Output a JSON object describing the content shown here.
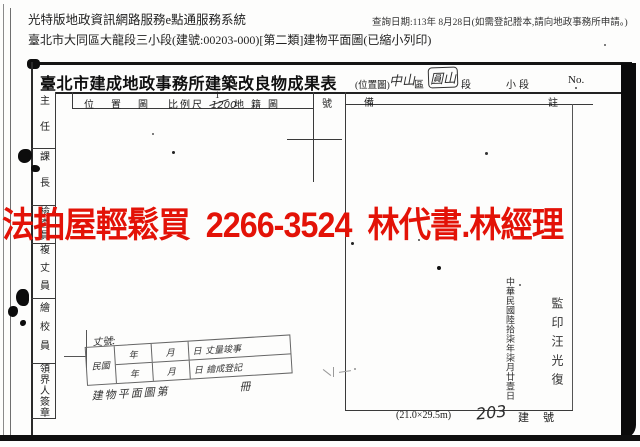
{
  "header": {
    "system_title": "光特版地政資訊網路服務e點通服務系統",
    "query_date": "查詢日期:113年 8月28日(如需登記謄本,請向地政事務所申請。)",
    "document_line": "臺北市大同區大龍段三小段(建號:00203-000)[第二類]建物平面圖(已縮小列印)"
  },
  "watermark": {
    "text": "法拍屋輕鬆買  2266-3524  林代書.林經理",
    "color": "#e31207"
  },
  "form": {
    "title": "臺北市建成地政事務所建築改良物成果表",
    "map_type_label": "(位置圖)",
    "district_value": "中山",
    "district_unit": "區",
    "section_value": "圓山",
    "section_unit": "段",
    "subsection_unit": "小段",
    "no_label": "No.",
    "columns": {
      "location_map": "位置圖",
      "scale_label": "比例尺",
      "scale_numerator": "1",
      "scale_denominator": "1200",
      "cadastral_map": "地籍圖",
      "number": "號",
      "remark_start": "備",
      "remark_end": "註"
    },
    "officials": [
      "主任",
      "課長",
      "檢查員",
      "複丈員",
      "繪校員",
      "領界人簽章"
    ],
    "survey_block": {
      "case_label": "丈號:",
      "era": "民國",
      "rows": [
        {
          "year": "年",
          "month": "月",
          "day": "日",
          "result": "丈量竣事"
        },
        {
          "year": "年",
          "month": "月",
          "day": "日",
          "result": "繪成登記"
        }
      ],
      "footer_label": "建物平面圖第",
      "footer_unit": "冊"
    },
    "stamps": {
      "date_vertical": "中華民國陸拾柒年柒月廿壹日",
      "seal_text": "監印汪光復"
    },
    "footer": {
      "sheet_size": "(21.0×29.5m)",
      "building_no_value": "203",
      "building_no_label": "建號"
    }
  }
}
